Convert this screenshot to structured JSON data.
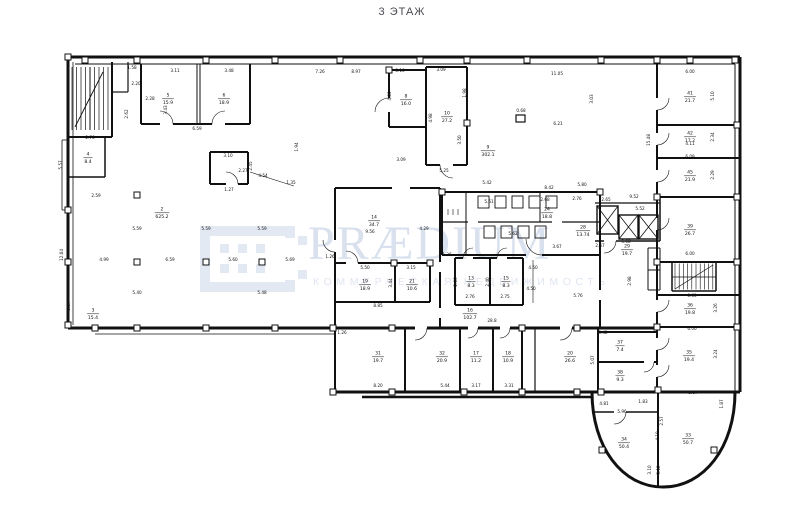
{
  "title": "3 ЭТАЖ",
  "watermark": {
    "brand": "PRÆDIUM",
    "tagline": "КОММЕРЧЕСКАЯ НЕДВИЖИМОСТЬ",
    "logo_color": "#e3e9f2",
    "brand_color": "#d9e1ee"
  },
  "plan": {
    "ink_color": "#111111",
    "rooms": [
      {
        "n": "5",
        "a": "15.9",
        "x": 168,
        "y": 98
      },
      {
        "n": "6",
        "a": "18.9",
        "x": 224,
        "y": 98
      },
      {
        "n": "4",
        "a": "8.4",
        "x": 88,
        "y": 157
      },
      {
        "n": "2",
        "a": "625.2",
        "x": 162,
        "y": 212
      },
      {
        "n": "9",
        "a": "302.1",
        "x": 488,
        "y": 150
      },
      {
        "n": "8",
        "a": "16.0",
        "x": 406,
        "y": 99
      },
      {
        "n": "10",
        "a": "27.2",
        "x": 447,
        "y": 116
      },
      {
        "n": "14",
        "a": "34.7",
        "x": 374,
        "y": 220
      },
      {
        "n": "19",
        "a": "18.9",
        "x": 365,
        "y": 284
      },
      {
        "n": "21",
        "a": "10.6",
        "x": 412,
        "y": 284
      },
      {
        "n": "13",
        "a": "8.3",
        "x": 471,
        "y": 281
      },
      {
        "n": "15",
        "a": "8.3",
        "x": 506,
        "y": 281
      },
      {
        "n": "16",
        "a": "102.7",
        "x": 470,
        "y": 313
      },
      {
        "n": "24",
        "a": "18.8",
        "x": 547,
        "y": 212
      },
      {
        "n": "28",
        "a": "13.74",
        "x": 583,
        "y": 230
      },
      {
        "n": "29",
        "a": "19.7",
        "x": 627,
        "y": 249
      },
      {
        "n": "31",
        "a": "19.7",
        "x": 378,
        "y": 356
      },
      {
        "n": "32",
        "a": "20.9",
        "x": 442,
        "y": 356
      },
      {
        "n": "17",
        "a": "11.2",
        "x": 476,
        "y": 356
      },
      {
        "n": "18",
        "a": "10.9",
        "x": 508,
        "y": 356
      },
      {
        "n": "20",
        "a": "26.6",
        "x": 570,
        "y": 356
      },
      {
        "n": "41",
        "a": "21.7",
        "x": 690,
        "y": 96
      },
      {
        "n": "42",
        "a": "17.2",
        "x": 690,
        "y": 136
      },
      {
        "n": "45",
        "a": "21.9",
        "x": 690,
        "y": 175
      },
      {
        "n": "39",
        "a": "26.7",
        "x": 690,
        "y": 229
      },
      {
        "n": "36",
        "a": "19.8",
        "x": 690,
        "y": 308
      },
      {
        "n": "35",
        "a": "19.4",
        "x": 689,
        "y": 355
      },
      {
        "n": "37",
        "a": "7.4",
        "x": 620,
        "y": 345
      },
      {
        "n": "38",
        "a": "9.3",
        "x": 620,
        "y": 375
      },
      {
        "n": "34",
        "a": "50.4",
        "x": 624,
        "y": 442
      },
      {
        "n": "33",
        "a": "50.7",
        "x": 688,
        "y": 438
      },
      {
        "n": "3",
        "a": "15.4",
        "x": 93,
        "y": 313
      }
    ],
    "dims": [
      {
        "t": "3.11",
        "x": 175,
        "y": 72
      },
      {
        "t": "3.48",
        "x": 229,
        "y": 72
      },
      {
        "t": "7.26",
        "x": 320,
        "y": 73
      },
      {
        "t": "8.97",
        "x": 356,
        "y": 73
      },
      {
        "t": "5.10",
        "x": 400,
        "y": 72
      },
      {
        "t": "3.09",
        "x": 441,
        "y": 71
      },
      {
        "t": "11.05",
        "x": 557,
        "y": 75
      },
      {
        "t": "6.00",
        "x": 690,
        "y": 73
      },
      {
        "t": "1.58",
        "x": 132,
        "y": 69
      },
      {
        "t": "2.20",
        "x": 136,
        "y": 85
      },
      {
        "t": "2.28",
        "x": 150,
        "y": 100
      },
      {
        "t": "2.62",
        "x": 128,
        "y": 114,
        "r": 1
      },
      {
        "t": "3.43",
        "x": 167,
        "y": 110,
        "r": 1
      },
      {
        "t": "2.76",
        "x": 90,
        "y": 139
      },
      {
        "t": "2.59",
        "x": 96,
        "y": 197
      },
      {
        "t": "6.59",
        "x": 197,
        "y": 130
      },
      {
        "t": "3.10",
        "x": 228,
        "y": 157
      },
      {
        "t": "2.45",
        "x": 252,
        "y": 166,
        "r": 1
      },
      {
        "t": "2.27",
        "x": 243,
        "y": 172
      },
      {
        "t": "4.54",
        "x": 263,
        "y": 177
      },
      {
        "t": "1.35",
        "x": 291,
        "y": 184
      },
      {
        "t": "1.27",
        "x": 229,
        "y": 191
      },
      {
        "t": "5.57",
        "x": 62,
        "y": 165,
        "r": 1
      },
      {
        "t": "12.04",
        "x": 63,
        "y": 255,
        "r": 1
      },
      {
        "t": "3.37",
        "x": 70,
        "y": 306,
        "r": 1
      },
      {
        "t": "5.59",
        "x": 137,
        "y": 230
      },
      {
        "t": "5.59",
        "x": 206,
        "y": 230
      },
      {
        "t": "5.59",
        "x": 262,
        "y": 230
      },
      {
        "t": "4.99",
        "x": 104,
        "y": 261
      },
      {
        "t": "6.59",
        "x": 170,
        "y": 261
      },
      {
        "t": "5.60",
        "x": 233,
        "y": 261
      },
      {
        "t": "5.69",
        "x": 290,
        "y": 261
      },
      {
        "t": "5.40",
        "x": 137,
        "y": 294
      },
      {
        "t": "5.48",
        "x": 262,
        "y": 294
      },
      {
        "t": "4.85",
        "x": 391,
        "y": 96,
        "r": 1
      },
      {
        "t": "1.98",
        "x": 466,
        "y": 93,
        "r": 1
      },
      {
        "t": "4.98",
        "x": 432,
        "y": 118,
        "r": 1
      },
      {
        "t": "3.09",
        "x": 401,
        "y": 161
      },
      {
        "t": "5.25",
        "x": 444,
        "y": 172
      },
      {
        "t": "3.50",
        "x": 461,
        "y": 140,
        "r": 1
      },
      {
        "t": "0.68",
        "x": 521,
        "y": 112
      },
      {
        "t": "6.21",
        "x": 558,
        "y": 125
      },
      {
        "t": "3.03",
        "x": 593,
        "y": 99,
        "r": 1
      },
      {
        "t": "5.10",
        "x": 714,
        "y": 96,
        "r": 1
      },
      {
        "t": "15.48",
        "x": 650,
        "y": 140,
        "r": 1
      },
      {
        "t": "2.34",
        "x": 714,
        "y": 137,
        "r": 1
      },
      {
        "t": "6.09",
        "x": 690,
        "y": 158
      },
      {
        "t": "2.29",
        "x": 714,
        "y": 175,
        "r": 1
      },
      {
        "t": "6.00",
        "x": 690,
        "y": 255
      },
      {
        "t": "9.56",
        "x": 370,
        "y": 233
      },
      {
        "t": "4.29",
        "x": 424,
        "y": 230
      },
      {
        "t": "1.26",
        "x": 330,
        "y": 258
      },
      {
        "t": "1.94",
        "x": 298,
        "y": 147,
        "r": 1
      },
      {
        "t": "5.50",
        "x": 365,
        "y": 269
      },
      {
        "t": "3.15",
        "x": 411,
        "y": 269
      },
      {
        "t": "8.85",
        "x": 378,
        "y": 307
      },
      {
        "t": "3.44",
        "x": 392,
        "y": 283,
        "r": 1
      },
      {
        "t": "5.42",
        "x": 487,
        "y": 184
      },
      {
        "t": "5.61",
        "x": 489,
        "y": 203
      },
      {
        "t": "8.42",
        "x": 549,
        "y": 189
      },
      {
        "t": "2.68",
        "x": 545,
        "y": 201
      },
      {
        "t": "2.76",
        "x": 577,
        "y": 200
      },
      {
        "t": "5.80",
        "x": 582,
        "y": 186
      },
      {
        "t": "2.65",
        "x": 606,
        "y": 201
      },
      {
        "t": "9.52",
        "x": 634,
        "y": 198
      },
      {
        "t": "5.52",
        "x": 640,
        "y": 210
      },
      {
        "t": "5.62",
        "x": 513,
        "y": 235
      },
      {
        "t": "3.67",
        "x": 557,
        "y": 248
      },
      {
        "t": "2.67",
        "x": 600,
        "y": 247
      },
      {
        "t": "5.68",
        "x": 626,
        "y": 243
      },
      {
        "t": "1.26",
        "x": 447,
        "y": 256
      },
      {
        "t": "4.50",
        "x": 533,
        "y": 269
      },
      {
        "t": "4.50",
        "x": 531,
        "y": 290
      },
      {
        "t": "5.76",
        "x": 578,
        "y": 297
      },
      {
        "t": "2.06",
        "x": 457,
        "y": 282,
        "r": 1
      },
      {
        "t": "2.40",
        "x": 489,
        "y": 282,
        "r": 1
      },
      {
        "t": "2.76",
        "x": 470,
        "y": 298
      },
      {
        "t": "2.75",
        "x": 505,
        "y": 298
      },
      {
        "t": "28.8",
        "x": 492,
        "y": 322
      },
      {
        "t": "1.26",
        "x": 342,
        "y": 334
      },
      {
        "t": "8.20",
        "x": 378,
        "y": 387
      },
      {
        "t": "5.44",
        "x": 445,
        "y": 387
      },
      {
        "t": "3.17",
        "x": 476,
        "y": 387
      },
      {
        "t": "3.31",
        "x": 509,
        "y": 387
      },
      {
        "t": "5.42",
        "x": 603,
        "y": 334
      },
      {
        "t": "2.98",
        "x": 631,
        "y": 281,
        "r": 1
      },
      {
        "t": "6.60",
        "x": 692,
        "y": 297
      },
      {
        "t": "3.26",
        "x": 717,
        "y": 308,
        "r": 1
      },
      {
        "t": "6.00",
        "x": 692,
        "y": 330
      },
      {
        "t": "3.24",
        "x": 717,
        "y": 354,
        "r": 1
      },
      {
        "t": "5.37",
        "x": 693,
        "y": 394
      },
      {
        "t": "1.87",
        "x": 723,
        "y": 404,
        "r": 1
      },
      {
        "t": "4.81",
        "x": 604,
        "y": 405
      },
      {
        "t": "5.96",
        "x": 622,
        "y": 413
      },
      {
        "t": "1.83",
        "x": 643,
        "y": 403
      },
      {
        "t": "2.57",
        "x": 663,
        "y": 421,
        "r": 1
      },
      {
        "t": "4.19",
        "x": 659,
        "y": 436,
        "r": 1
      },
      {
        "t": "3.10",
        "x": 651,
        "y": 470,
        "r": 1
      },
      {
        "t": "3.12",
        "x": 660,
        "y": 470,
        "r": 1
      },
      {
        "t": "5.07",
        "x": 594,
        "y": 360,
        "r": 1
      },
      {
        "t": "4.11",
        "x": 690,
        "y": 145
      }
    ]
  }
}
